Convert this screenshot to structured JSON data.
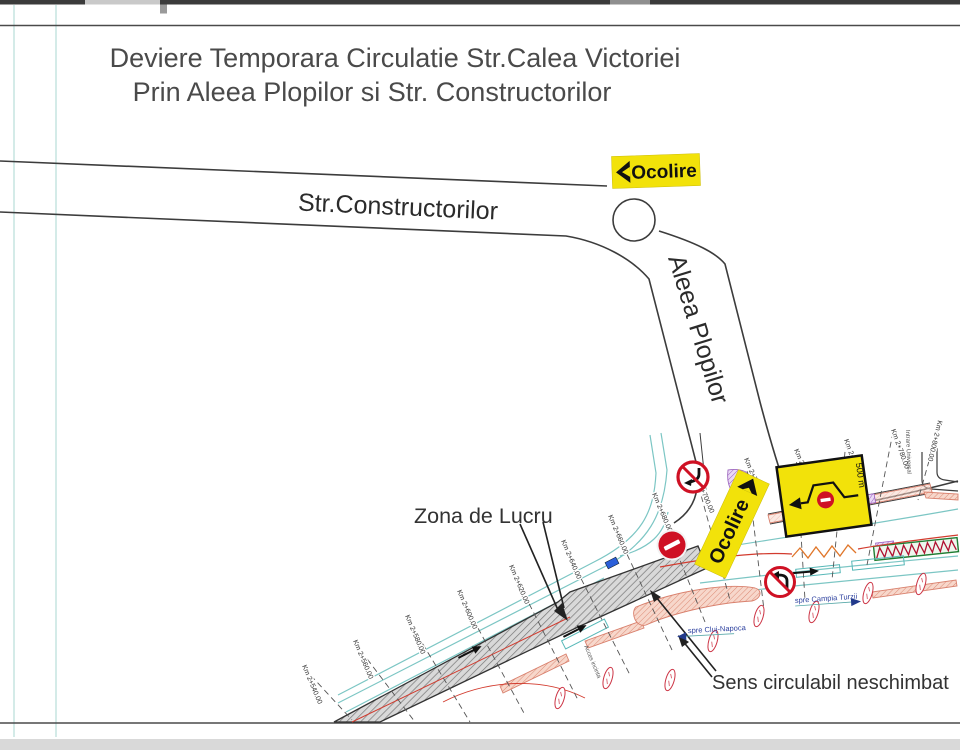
{
  "title": {
    "line1": "Deviere Temporara Circulatie Str.Calea Victoriei",
    "line2": "Prin Aleea Plopilor si Str. Constructorilor"
  },
  "roads": {
    "constructorilor": "Str.Constructorilor",
    "plopilor": "Aleea Plopilor"
  },
  "signs": {
    "ocolire_top": "Ocolire",
    "ocolire_junction": "Ocolire",
    "detour_distance": "500 m"
  },
  "labels": {
    "work_zone": "Zona de Lucru",
    "unchanged": "Sens circulabil neschimbat",
    "to_cluj": "spre Cluj-Napoca",
    "to_campia": "spre Campia Turzii",
    "access": "Acces incinta",
    "side_entry": "Intrare Universal"
  },
  "stations": [
    {
      "label": "Km 2+540.00"
    },
    {
      "label": "Km 2+560.00"
    },
    {
      "label": "Km 2+580.00"
    },
    {
      "label": "Km 2+600.00"
    },
    {
      "label": "Km 2+620.00"
    },
    {
      "label": "Km 2+640.00"
    },
    {
      "label": "Km 2+660.00"
    },
    {
      "label": "Km 2+680.00"
    },
    {
      "label": "Km 2+700.00"
    },
    {
      "label": "Km 2+720.00"
    },
    {
      "label": "Km 2+740.00"
    },
    {
      "label": "Km 2+760.00"
    },
    {
      "label": "Km 2+780.00"
    },
    {
      "label": "Km 2+800.00"
    }
  ],
  "colors": {
    "sign_yellow": "#f2e20a",
    "no_entry_red": "#cf1124",
    "road_line_dark": "#3c3c3c",
    "road_teal": "#7cc6c4",
    "marking_red": "#d23b2e",
    "island_pink": "#f7d7cb",
    "barrier_green": "#1e7d32",
    "work_hatch_gray": "#8a8a8a",
    "detail_violet": "#9a5fc0",
    "title_gray": "#4a4a4a",
    "blue_label": "#2b3f9e"
  }
}
